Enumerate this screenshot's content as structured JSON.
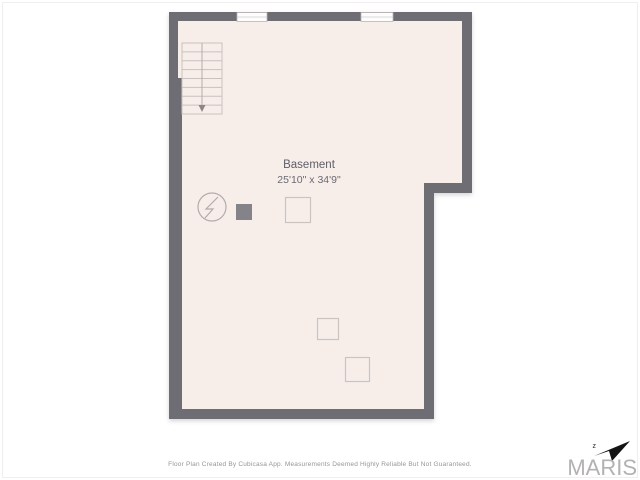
{
  "plan": {
    "room_label": "Basement",
    "room_dimensions": "25'10\" x 34'9\"",
    "footer_disclaimer": "Floor Plan Created By Cubicasa App. Measurements Deemed Highly Reliable But Not Guaranteed.",
    "windows_count": 2,
    "logo": {
      "text": "MARIS",
      "mark": "z"
    }
  },
  "colors": {
    "background": "#ffffff",
    "wall": "#6f6d74",
    "floor": "#f7eeea",
    "stair_stroke": "#c9c1be",
    "stair_arrow": "#8d8784",
    "symbol_stroke": "#b4acab",
    "box_stroke": "#cbc3c0",
    "post_fill": "#85838a",
    "window_fill": "#fdfdfd",
    "label_text": "#5e5d67",
    "footer_text": "#969696",
    "logo_text": "#b3b1b1",
    "logo_arrow": "#141414"
  }
}
